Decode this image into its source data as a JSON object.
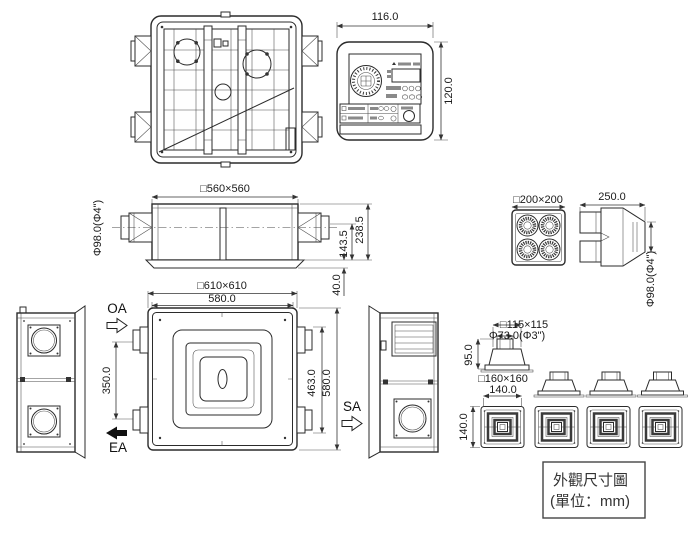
{
  "title_box": {
    "line1": "外觀尺寸圖",
    "line2": "(單位：mm)"
  },
  "controller": {
    "width_dim": "116.0",
    "height_dim": "120.0"
  },
  "elevation": {
    "top_dim": "□560×560",
    "duct_label": "Φ98.0(Φ4\")",
    "inner_height_dim": "143.5",
    "body_height_dim": "238.5",
    "flange_height_dim": "40.0"
  },
  "grille": {
    "size_dim": "□200×200"
  },
  "adapter": {
    "length_dim": "250.0",
    "duct_label": "Φ98.0(Φ4\")"
  },
  "bottom_view": {
    "outer_dim": "□610×610",
    "inner_width_dim": "580.0",
    "inner_height_dim": "463.0",
    "outer_height_dim": "580.0"
  },
  "airflow": {
    "oa": "OA",
    "ea": "EA",
    "sa": "SA",
    "duct_spacing_dim": "350.0"
  },
  "diffuser": {
    "neck_dim": "□115×115",
    "collar_dim": "Φ73.0(Φ3\")",
    "height_dim": "95.0",
    "panel_dim": "□160×160",
    "width_dim": "140.0",
    "depth_dim": "140.0"
  }
}
